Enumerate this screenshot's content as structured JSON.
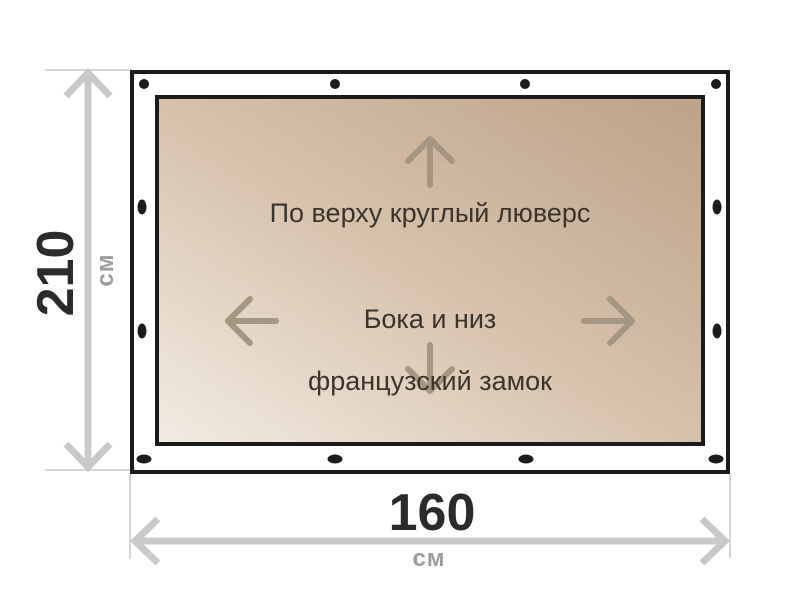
{
  "figure": {
    "type": "product-dimension-diagram",
    "height_dimension": {
      "value": "210",
      "unit": "см"
    },
    "width_dimension": {
      "value": "160",
      "unit": "см"
    },
    "annotations": {
      "top_edge": "По верху круглый люверс",
      "sides_line1": "Бока и низ",
      "sides_line2": "французский замок"
    },
    "icons": {
      "up": "arrow-up-icon",
      "down": "arrow-down-icon",
      "left": "arrow-left-icon",
      "right": "arrow-right-icon"
    },
    "grommets": {
      "top_count": 4,
      "bottom_count": 4,
      "left_count": 2,
      "right_count": 2,
      "top_shape": "round",
      "side_and_bottom_shape": "slot"
    },
    "colors": {
      "canvas_bg": "#ffffff",
      "outline": "#1b1b1b",
      "tarp_light": "#f2ece3",
      "tarp_mid": "#d6c1ab",
      "tarp_dark": "#bca288",
      "grommet": "#1b1b1b",
      "inner_arrow": "#a49682",
      "annotation_text": "#3b342c",
      "dimension_arrow": "#c9c9c9",
      "extension_line": "#d6d6d6",
      "dimension_value": "#2b2b2b",
      "dimension_unit": "#9c9c9c"
    }
  }
}
